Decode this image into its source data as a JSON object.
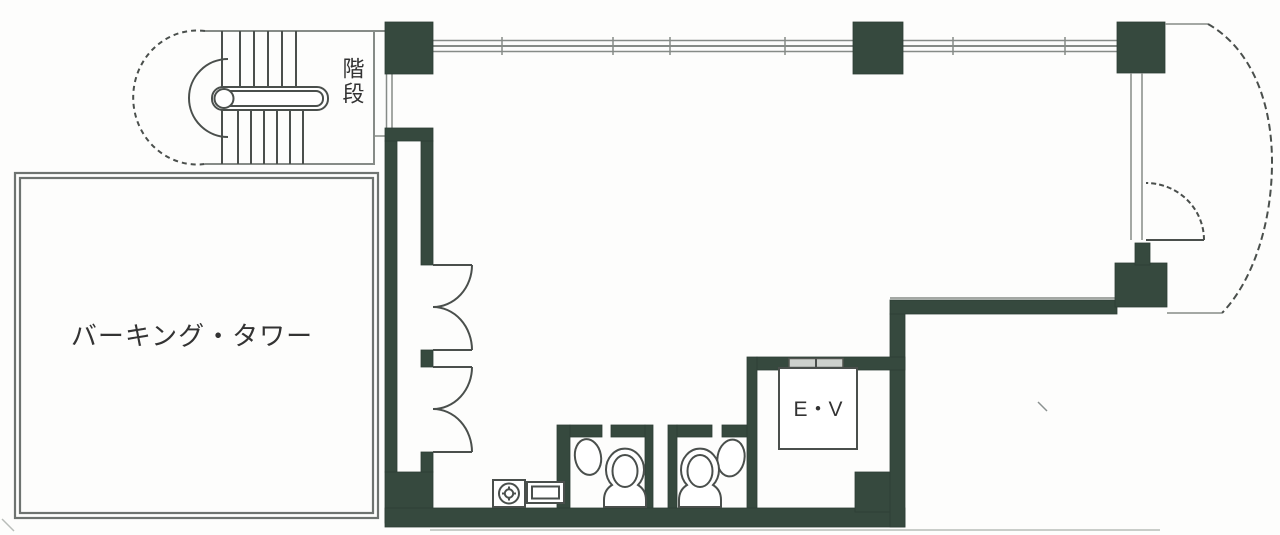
{
  "plan": {
    "type": "architectural-floor-plan",
    "rooms": [
      {
        "id": "stairs",
        "label": "階段"
      },
      {
        "id": "parking-tower",
        "label": "バーキング・タワー"
      },
      {
        "id": "elevator",
        "label": "E・V"
      }
    ]
  },
  "colors": {
    "wall": "#36493e",
    "thin_line": "#868b87",
    "draw_line": "#4a4f4c",
    "parking_outline": "#6e7370",
    "background": "#fdfdfc",
    "text": "#333333"
  }
}
